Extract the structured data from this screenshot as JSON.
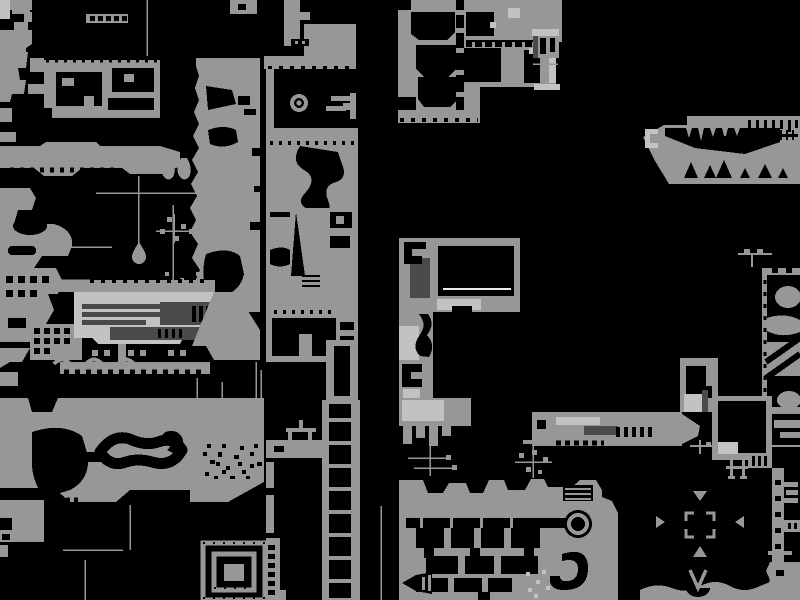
{
  "canvas": {
    "width": 800,
    "height": 600
  },
  "palette": {
    "bg": "#000000",
    "mid": "#97979a",
    "light": "#c2c2c4",
    "dark": "#4a4a4c",
    "white": "#ededef"
  },
  "map": {
    "style": "pixel-art world map, gray terrain on black",
    "features": [
      "eye-emblem",
      "hanging-droplet-wire",
      "crashed-ship",
      "elevator-shaft",
      "s-canyon",
      "compass-arrow-chamber",
      "target-brackets",
      "spiral-vault",
      "stalactite-cave",
      "ringed-portal",
      "rubble-field",
      "room-grid-building",
      "wire-lines",
      "window-panels"
    ]
  }
}
